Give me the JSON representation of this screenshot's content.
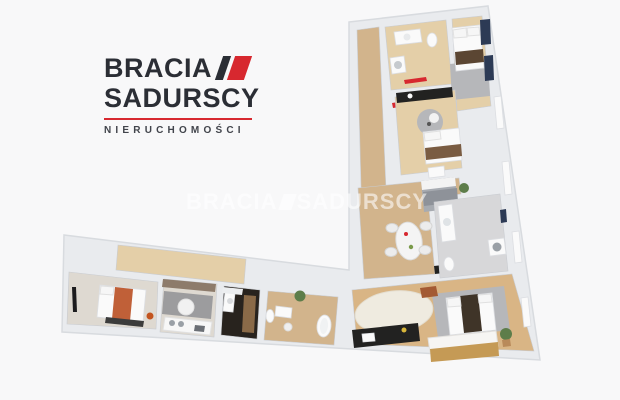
{
  "page": {
    "background": "#f8f8f9",
    "description": "3D dollhouse render of an L-shaped apartment floor plan with real-estate agency branding"
  },
  "logo": {
    "line1": "BRACIA",
    "line2": "SADURSCY",
    "tagline": "NIERUCHOMOŚCI"
  },
  "watermark": {
    "word1": "BRACIA",
    "word2": "SADURSCY"
  },
  "palette": {
    "bg": "#f8f8f9",
    "ink": "#2b2e35",
    "red": "#d7282f",
    "wmwhite": "rgba(255,255,255,0.58)",
    "wall": "#e9ebee",
    "wallline": "#d8dbdf",
    "wood": "#d2b48c",
    "woodlight": "#e4cfa8",
    "woodwarm": "#d9b585",
    "pale": "#ded9d1",
    "tilegray": "#d7d7d9",
    "tiledark": "#28231e",
    "ruggray": "#b6b7ba",
    "speckle": "#9c9c9e",
    "navy": "#2c3a55",
    "counter": "#222221",
    "green": "#5d7d4a",
    "taupe": "#8d7b6b",
    "shag": "#efebe0",
    "white": "#fafafa"
  },
  "floor_plan": {
    "rooms": [
      "hallway",
      "bathroom-top",
      "bedroom-top-right",
      "bedroom-middle",
      "living-dining",
      "bathroom-right",
      "living-room-kitchen",
      "storage-room",
      "bedroom-left",
      "lounge",
      "dark-bathroom",
      "nursery"
    ]
  }
}
